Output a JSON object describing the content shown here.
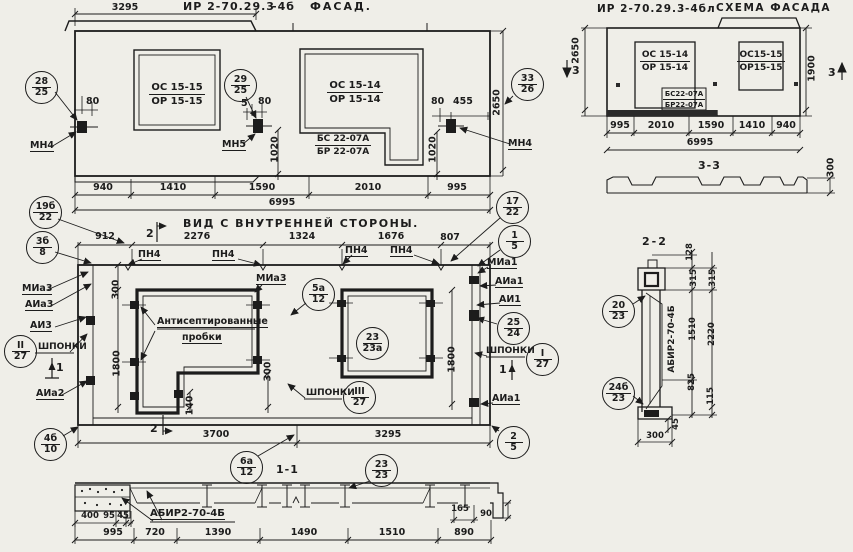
{
  "facade": {
    "code": "ИР 2-70.29.3",
    "code_suffix": "-4б",
    "title": "ФАСАД.",
    "dim_top": "3295",
    "win_left_top": "ОС 15-15",
    "win_left_bot": "ОР 15-15",
    "win_right_top": "ОС 15-14",
    "win_right_bot": "ОР 15-14",
    "door_top": "БС 22-07А",
    "door_bot": "БР 22-07А",
    "b28": [
      "28",
      "25"
    ],
    "b29": [
      "29",
      "25"
    ],
    "b33": [
      "33",
      "26"
    ],
    "mn4l": "МН4",
    "mn5": "МН5",
    "mn4r": "МН4",
    "d80l": "80",
    "d5": "5",
    "d80m": "80",
    "d80r": "80",
    "d455": "455",
    "d1020l": "1020",
    "d1020r": "1020",
    "d2650": "2650",
    "chain": [
      "940",
      "1410",
      "1590",
      "2010",
      "995"
    ],
    "total": "6995"
  },
  "schema": {
    "code": "ИР 2-70.29.3",
    "code_suffix": "-4бл",
    "title": "СХЕМА ФАСАДА",
    "win_left_top": "ОС 15-14",
    "win_left_bot": "ОР 15-14",
    "door_top": "БС22-07А",
    "door_bot": "БР22-07А",
    "win_right_top": "ОС15-15",
    "win_right_bot": "ОР15-15",
    "d2650": "2650",
    "d1900": "1900",
    "sec3": "3",
    "chain": [
      "995",
      "2010",
      "1590",
      "1410",
      "940"
    ],
    "total": "6995",
    "sec33_title": "3-3",
    "d300": "300"
  },
  "inner": {
    "title": "ВИД С ВНУТРЕННЕЙ СТОРОНЫ.",
    "sec2": "2",
    "sec1": "1",
    "chain_top": [
      "912",
      "2276",
      "1324",
      "1676",
      "807"
    ],
    "pn4": "ПН4",
    "b19b": [
      "19б",
      "22"
    ],
    "b3b": [
      "3б",
      "8"
    ],
    "b17": [
      "17",
      "22"
    ],
    "b1": [
      "1",
      "5"
    ],
    "b5a": [
      "5а",
      "12"
    ],
    "b25": [
      "25",
      "24"
    ],
    "bI": [
      "I",
      "27"
    ],
    "bII": [
      "II",
      "27"
    ],
    "bIII": [
      "III",
      "27"
    ],
    "b23": [
      "23",
      "23а"
    ],
    "b2": [
      "2",
      "5"
    ],
    "b4b": [
      "4б",
      "10"
    ],
    "b6a": [
      "6а",
      "12"
    ],
    "mia3": "МИа3",
    "aia3": "АИа3",
    "ai3": "АИ3",
    "shponki": "ШПОНКИ",
    "aia2": "АИа2",
    "mia3_c": "МИа3",
    "mia1": "МИа1",
    "aia1": "АИа1",
    "ai1": "АИ1",
    "aia1b": "АИа1",
    "plugs_line1": "Антисептированные",
    "plugs_line2": "пробки",
    "d300t": "300",
    "d1800l": "1800",
    "d300r": "300",
    "d140": "140",
    "d1800r": "1800",
    "d3700": "3700",
    "d3295": "3295"
  },
  "section_1_1": {
    "title": "1-1",
    "label": "АБИР2-70-4Б",
    "b23": [
      "23",
      "23"
    ],
    "d400": "400",
    "d95": "95",
    "d45": "45",
    "d165": "165",
    "d90": "90",
    "chain": [
      "995",
      "720",
      "1390",
      "1490",
      "1510",
      "890"
    ]
  },
  "section_2_2": {
    "title": "2-2",
    "label": "АБИР2-70-4Б",
    "b20": [
      "20",
      "23"
    ],
    "b24b": [
      "24б",
      "23"
    ],
    "d128": "128",
    "d315a": "315",
    "d315b": "315",
    "d1510": "1510",
    "d2220": "2220",
    "d825": "825",
    "d115": "115",
    "d45": "45",
    "d300": "300"
  }
}
